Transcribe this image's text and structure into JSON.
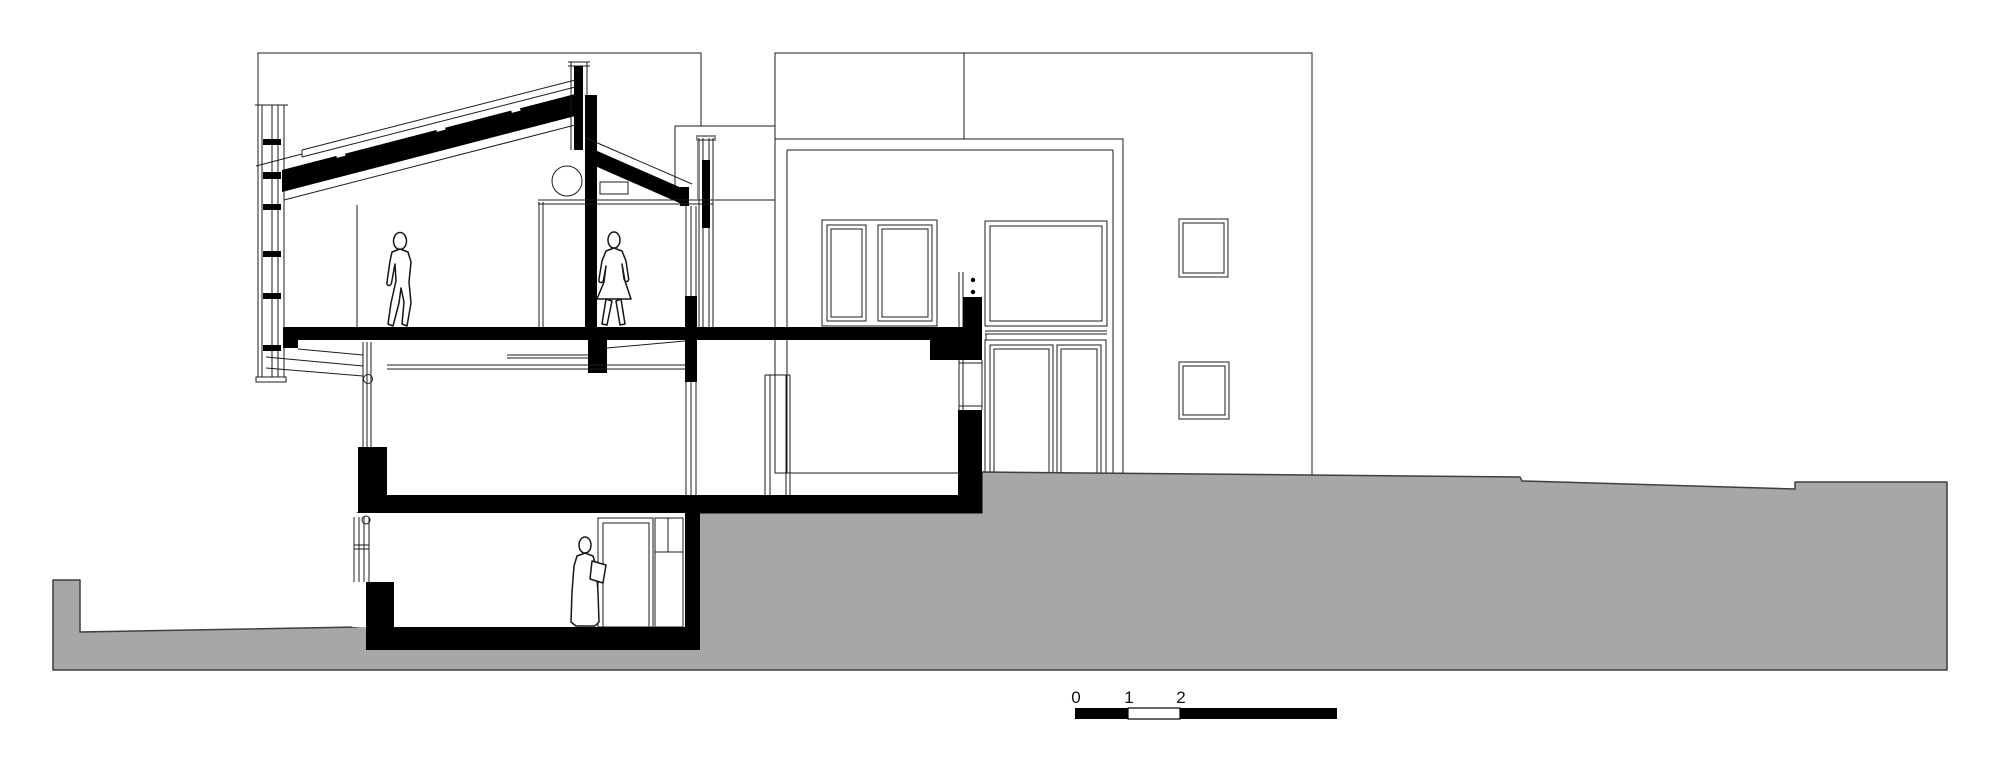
{
  "scale_bar": {
    "labels": [
      "0",
      "1",
      "2",
      "5"
    ]
  },
  "colors": {
    "terrain_gray": "#a7a7a7",
    "ink": "#1c1c1c",
    "poche_black": "#000000",
    "paper_white": "#ffffff"
  },
  "figures": {
    "upper_left": "walking-person",
    "upper_right": "standing-person",
    "basement": "person-at-door"
  }
}
